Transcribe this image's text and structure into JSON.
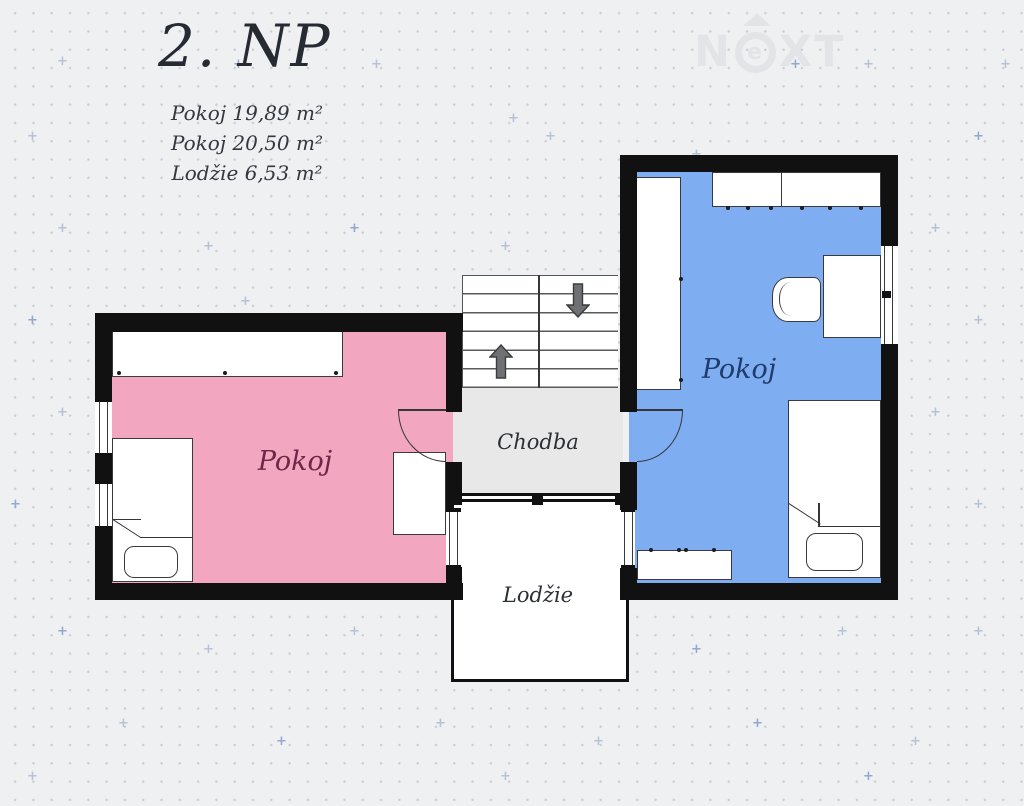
{
  "title": "2. NP",
  "legend": {
    "items": [
      "Pokoj 19,89 m²",
      "Pokoj 20,50 m²",
      "Lodžie 6,53 m²"
    ]
  },
  "watermark": {
    "brand": "NEXT",
    "pre": "N",
    "circled": "e",
    "post": "XT"
  },
  "rooms": {
    "room_left": {
      "label": "Pokoj"
    },
    "room_right": {
      "label": "Pokoj"
    },
    "hallway": {
      "label": "Chodba"
    },
    "loggia": {
      "label": "Lodžie"
    }
  },
  "pattern": {
    "plus": "+"
  },
  "colors": {
    "background": "#eef0f1",
    "wall": "#111111",
    "room-left-fill": "#f3a6bf",
    "room-right-fill": "#7fadf2",
    "hallway-fill": "#e8e8e9",
    "room-left-label": "#6d2747",
    "room-right-label": "#1f3c6b",
    "plan-label": "#2b2f36",
    "title": "#262a32",
    "watermark": "#e2e4e7"
  }
}
